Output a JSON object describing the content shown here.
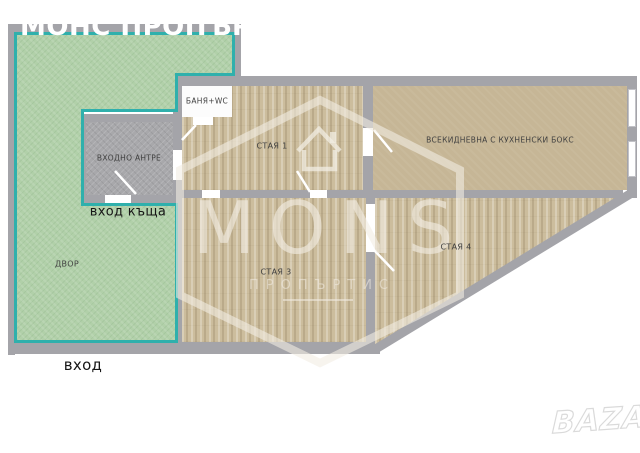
{
  "title": "МОНС ПРОПЪРТИС",
  "rooms": {
    "yard": "ДВОР",
    "entry_hall": "ВХОДНО АНТРЕ",
    "bathroom": "БАНЯ+WC",
    "room1": "СТАЯ 1",
    "living": "ВСЕКИДНЕВНА С КУХНЕНСКИ БОКС",
    "room3": "СТАЯ 3",
    "room4": "СТАЯ 4"
  },
  "annotations": {
    "house_entrance": "вход къща",
    "entrance": "вход"
  },
  "watermark": {
    "name": "MONS",
    "sub": "ПРОПЪРТИС"
  },
  "agency_logo": "BAZAR",
  "colors": {
    "yard_green": "#b1d0a9",
    "yard_border_teal": "#2fb0ac",
    "wall_gray": "#a4a4a9",
    "wood_floor": "#ccbd9d",
    "living_floor": "#c6b696",
    "entry_floor": "#a8a8ab",
    "watermark_cream": "#f2ede3",
    "title_white": "#ffffff"
  }
}
